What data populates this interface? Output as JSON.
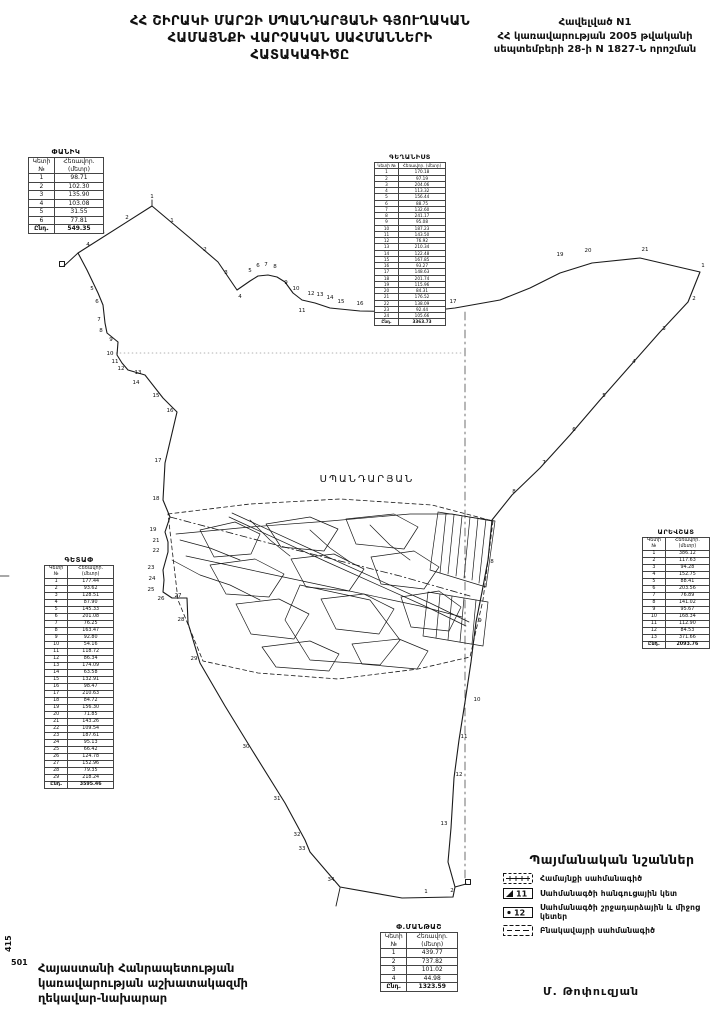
{
  "page": {
    "title_lines": [
      "ՀՀ ՇԻՐԱԿԻ ՄԱՐԶԻ ՍՊԱՆԴԱՐՅԱՆԻ ԳՅՈՒՂԱԿԱՆ",
      "ՀԱՄԱՅՆՔԻ ՎԱՐՉԱԿԱՆ  ՍԱՀՄԱՆՆԵՐԻ",
      "ՀԱՏԱԿԱԳԻԾԸ"
    ],
    "appendix_lines": [
      "Հավելված N1",
      "ՀՀ կառավարության 2005 թվականի",
      "սեպտեմբերի 28-ի N 1827-Ն որոշման"
    ],
    "sheet_number_vertical": "415",
    "sheet_number": "501",
    "footer_left_lines": [
      "Հայաստանի Հանրապետության",
      "կառավարության աշխատակազմի",
      "ղեկավար-նախարար"
    ],
    "signature": "Մ. Թոփուզյան"
  },
  "map": {
    "settlement_label": "ՍՊԱՆԴԱՐՅԱՆ",
    "line_color": "#1a1a1a",
    "boundary_points": [
      {
        "n": "1",
        "x": 152,
        "y": 198
      },
      {
        "n": "2",
        "x": 127,
        "y": 219
      },
      {
        "n": "3",
        "x": 103,
        "y": 234
      },
      {
        "n": "4",
        "x": 88,
        "y": 246
      },
      {
        "n": "1",
        "x": 172,
        "y": 222
      },
      {
        "n": "2",
        "x": 205,
        "y": 251
      },
      {
        "n": "3",
        "x": 226,
        "y": 274
      },
      {
        "n": "4",
        "x": 240,
        "y": 298
      },
      {
        "n": "5",
        "x": 250,
        "y": 272
      },
      {
        "n": "6",
        "x": 258,
        "y": 267
      },
      {
        "n": "7",
        "x": 266,
        "y": 266
      },
      {
        "n": "8",
        "x": 275,
        "y": 268
      },
      {
        "n": "9",
        "x": 286,
        "y": 284
      },
      {
        "n": "10",
        "x": 296,
        "y": 290
      },
      {
        "n": "11",
        "x": 302,
        "y": 312
      },
      {
        "n": "12",
        "x": 311,
        "y": 295
      },
      {
        "n": "13",
        "x": 320,
        "y": 296
      },
      {
        "n": "14",
        "x": 330,
        "y": 299
      },
      {
        "n": "15",
        "x": 341,
        "y": 303
      },
      {
        "n": "16",
        "x": 360,
        "y": 305
      },
      {
        "n": "18",
        "x": 400,
        "y": 319
      },
      {
        "n": "17",
        "x": 453,
        "y": 303
      },
      {
        "n": "19",
        "x": 560,
        "y": 256
      },
      {
        "n": "20",
        "x": 588,
        "y": 252
      },
      {
        "n": "21",
        "x": 645,
        "y": 251
      },
      {
        "n": "1",
        "x": 703,
        "y": 267
      },
      {
        "n": "2",
        "x": 694,
        "y": 300
      },
      {
        "n": "3",
        "x": 664,
        "y": 330
      },
      {
        "n": "4",
        "x": 634,
        "y": 363
      },
      {
        "n": "5",
        "x": 604,
        "y": 397
      },
      {
        "n": "6",
        "x": 574,
        "y": 431
      },
      {
        "n": "7",
        "x": 544,
        "y": 464
      },
      {
        "n": "8",
        "x": 514,
        "y": 493
      },
      {
        "n": "8",
        "x": 492,
        "y": 563
      },
      {
        "n": "9",
        "x": 480,
        "y": 622
      },
      {
        "n": "10",
        "x": 477,
        "y": 701
      },
      {
        "n": "11",
        "x": 464,
        "y": 738
      },
      {
        "n": "12",
        "x": 459,
        "y": 776
      },
      {
        "n": "13",
        "x": 444,
        "y": 825
      },
      {
        "n": "5",
        "x": 92,
        "y": 290
      },
      {
        "n": "6",
        "x": 97,
        "y": 303
      },
      {
        "n": "7",
        "x": 99,
        "y": 321
      },
      {
        "n": "8",
        "x": 101,
        "y": 332
      },
      {
        "n": "9",
        "x": 111,
        "y": 341
      },
      {
        "n": "10",
        "x": 110,
        "y": 355
      },
      {
        "n": "11",
        "x": 115,
        "y": 363
      },
      {
        "n": "12",
        "x": 121,
        "y": 370
      },
      {
        "n": "13",
        "x": 138,
        "y": 374
      },
      {
        "n": "14",
        "x": 136,
        "y": 384
      },
      {
        "n": "15",
        "x": 156,
        "y": 397
      },
      {
        "n": "16",
        "x": 170,
        "y": 412
      },
      {
        "n": "17",
        "x": 158,
        "y": 462
      },
      {
        "n": "18",
        "x": 156,
        "y": 500
      },
      {
        "n": "19",
        "x": 153,
        "y": 531
      },
      {
        "n": "21",
        "x": 156,
        "y": 542
      },
      {
        "n": "22",
        "x": 156,
        "y": 552
      },
      {
        "n": "23",
        "x": 151,
        "y": 569
      },
      {
        "n": "24",
        "x": 152,
        "y": 580
      },
      {
        "n": "25",
        "x": 151,
        "y": 591
      },
      {
        "n": "26",
        "x": 161,
        "y": 600
      },
      {
        "n": "27",
        "x": 178,
        "y": 597
      },
      {
        "n": "28",
        "x": 181,
        "y": 621
      },
      {
        "n": "29",
        "x": 194,
        "y": 660
      },
      {
        "n": "30",
        "x": 246,
        "y": 748
      },
      {
        "n": "31",
        "x": 277,
        "y": 800
      },
      {
        "n": "32",
        "x": 297,
        "y": 836
      },
      {
        "n": "33",
        "x": 302,
        "y": 850
      },
      {
        "n": "34",
        "x": 331,
        "y": 881
      },
      {
        "n": "1",
        "x": 426,
        "y": 893
      },
      {
        "n": "2",
        "x": 452,
        "y": 892
      }
    ]
  },
  "legend": {
    "title": "Պայմանական նշաններ",
    "items": [
      {
        "label": "Համայնքի սահմանագիծ",
        "symbol_text": ""
      },
      {
        "label": "Սահմանագծի հանգուցային կետ",
        "symbol_text": "11"
      },
      {
        "label": "Սահմանագծի շրջադարձային և միջոց կետեր",
        "symbol_text": "12"
      },
      {
        "label": "Բնակավայրի սահմանագիծ",
        "symbol_text": ""
      }
    ]
  },
  "table_headers": {
    "col1": "Կետի №",
    "col2": "Հեռավոր. (մետր)",
    "total_label": "Ընդ."
  },
  "tables": [
    {
      "id": "panik",
      "title": "ՓԱՆԻԿ",
      "total": "549.35",
      "rows": [
        [
          "1",
          "98.71"
        ],
        [
          "2",
          "102.30"
        ],
        [
          "3",
          "135.90"
        ],
        [
          "4",
          "103.08"
        ],
        [
          "5",
          "31.55"
        ],
        [
          "6",
          "77.81"
        ]
      ]
    },
    {
      "id": "geghanist",
      "title": "ԳԵՂԱՆԻՍՏ",
      "total": "3363.73",
      "rows": [
        [
          "1",
          "170.18"
        ],
        [
          "2",
          "97.19"
        ],
        [
          "3",
          "204.06"
        ],
        [
          "4",
          "113.32"
        ],
        [
          "5",
          "156.44"
        ],
        [
          "6",
          "88.75"
        ],
        [
          "7",
          "132.60"
        ],
        [
          "8",
          "241.17"
        ],
        [
          "9",
          "95.08"
        ],
        [
          "10",
          "187.23"
        ],
        [
          "11",
          "143.50"
        ],
        [
          "12",
          "76.92"
        ],
        [
          "13",
          "210.34"
        ],
        [
          "14",
          "122.48"
        ],
        [
          "15",
          "167.85"
        ],
        [
          "16",
          "93.27"
        ],
        [
          "17",
          "148.63"
        ],
        [
          "18",
          "201.74"
        ],
        [
          "19",
          "115.96"
        ],
        [
          "20",
          "84.31"
        ],
        [
          "21",
          "176.52"
        ],
        [
          "22",
          "138.09"
        ],
        [
          "23",
          "92.44"
        ],
        [
          "24",
          "105.66"
        ]
      ]
    },
    {
      "id": "getap",
      "title": "ԳԵՏԱՓ",
      "total": "3595.46",
      "rows": [
        [
          "1",
          "177.44"
        ],
        [
          "2",
          "93.62"
        ],
        [
          "3",
          "128.51"
        ],
        [
          "4",
          "87.90"
        ],
        [
          "5",
          "145.33"
        ],
        [
          "6",
          "201.08"
        ],
        [
          "7",
          "76.25"
        ],
        [
          "8",
          "163.47"
        ],
        [
          "9",
          "92.80"
        ],
        [
          "10",
          "54.16"
        ],
        [
          "11",
          "118.72"
        ],
        [
          "12",
          "86.34"
        ],
        [
          "13",
          "174.09"
        ],
        [
          "14",
          "63.58"
        ],
        [
          "15",
          "132.91"
        ],
        [
          "16",
          "98.47"
        ],
        [
          "17",
          "210.63"
        ],
        [
          "18",
          "84.72"
        ],
        [
          "19",
          "156.30"
        ],
        [
          "20",
          "71.85"
        ],
        [
          "21",
          "143.26"
        ],
        [
          "22",
          "109.54"
        ],
        [
          "23",
          "187.61"
        ],
        [
          "24",
          "95.13"
        ],
        [
          "25",
          "66.42"
        ],
        [
          "26",
          "124.78"
        ],
        [
          "27",
          "152.96"
        ],
        [
          "28",
          "79.35"
        ],
        [
          "29",
          "218.24"
        ]
      ]
    },
    {
      "id": "arevshat",
      "title": "ԱՐԵՎՇԱՏ",
      "total": "2093.76",
      "rows": [
        [
          "1",
          "386.12"
        ],
        [
          "2",
          "117.63"
        ],
        [
          "3",
          "94.28"
        ],
        [
          "4",
          "152.75"
        ],
        [
          "5",
          "88.41"
        ],
        [
          "6",
          "203.56"
        ],
        [
          "7",
          "76.89"
        ],
        [
          "8",
          "141.02"
        ],
        [
          "9",
          "95.67"
        ],
        [
          "10",
          "168.34"
        ],
        [
          "11",
          "112.90"
        ],
        [
          "12",
          "84.53"
        ],
        [
          "13",
          "371.66"
        ]
      ]
    },
    {
      "id": "mantash",
      "title": "Փ.ՄԱՆԹԱՇ",
      "total": "1323.59",
      "rows": [
        [
          "1",
          "439.77"
        ],
        [
          "2",
          "737.82"
        ],
        [
          "3",
          "101.02"
        ],
        [
          "4",
          "44.98"
        ]
      ]
    }
  ]
}
